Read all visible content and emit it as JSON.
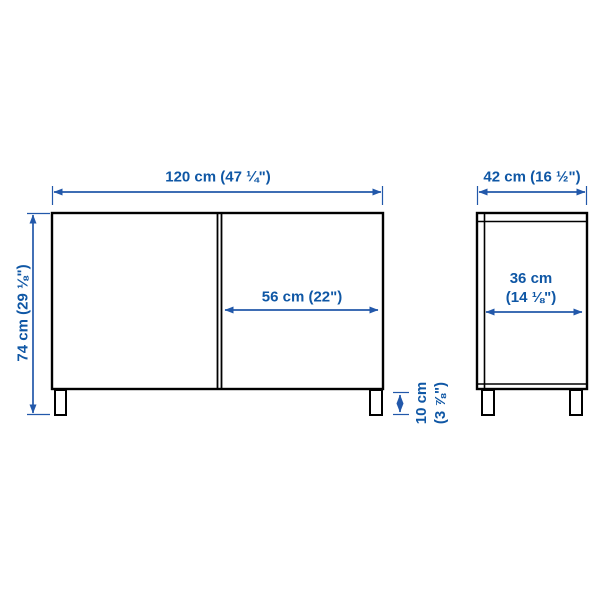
{
  "diagram": {
    "title": "cabinet-dimension-diagram",
    "colors": {
      "outline": "#000000",
      "dimension_line": "#2258aa",
      "label_text": "#0f57a5",
      "background": "#ffffff"
    },
    "front_view": {
      "overall_width": "120 cm (47 ¼\")",
      "overall_height": "74 cm (29 ⅛\")",
      "door_width": "56 cm (22\")",
      "leg_height": {
        "line1": "10 cm",
        "line2": "(3 ⅞\")"
      }
    },
    "side_view": {
      "overall_depth": "42 cm (16 ½\")",
      "inner_depth": {
        "line1": "36 cm",
        "line2": "(14 ⅛\")"
      }
    }
  }
}
